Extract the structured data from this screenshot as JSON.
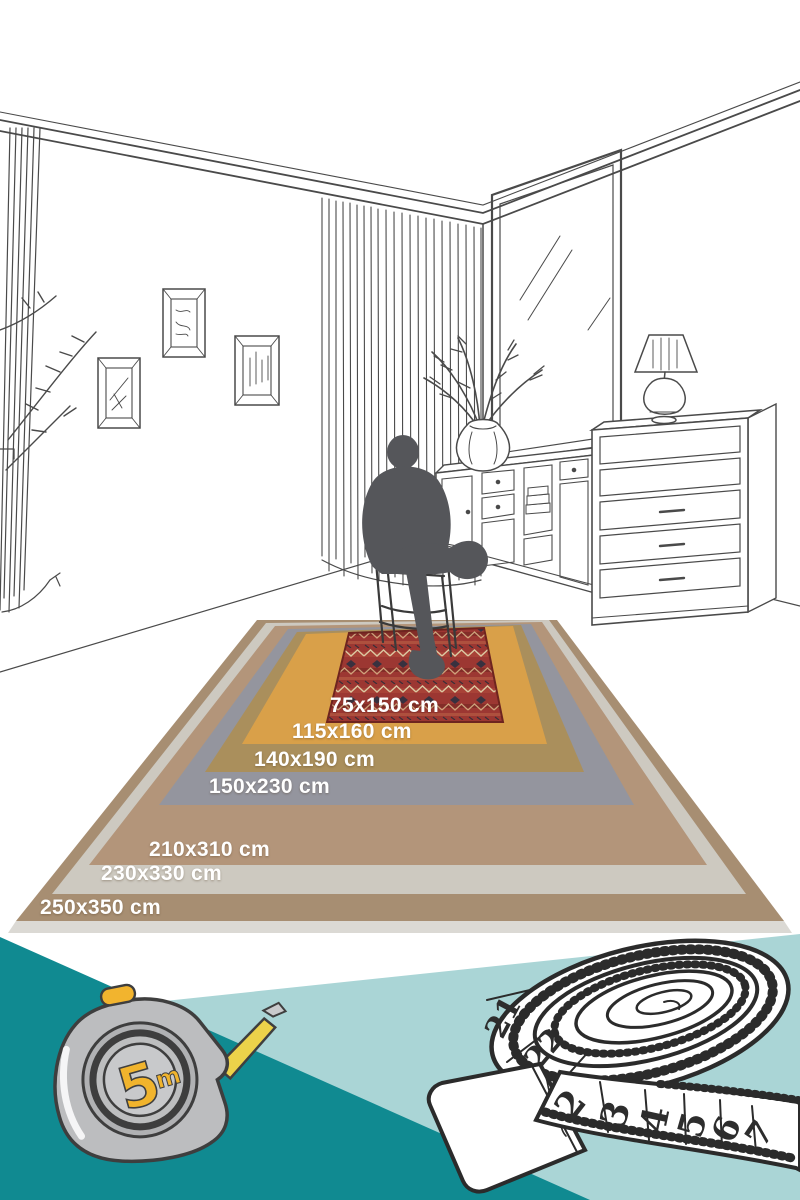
{
  "rugs": {
    "items": [
      {
        "label": "250x350 cm",
        "color": "#a78e72"
      },
      {
        "label": "230x330 cm",
        "color": "#cdc9c0"
      },
      {
        "label": "210x310 cm",
        "color": "#b3957a"
      },
      {
        "label": "150x230 cm",
        "color": "#94959e"
      },
      {
        "label": "140x190 cm",
        "color": "#aa8f5c"
      },
      {
        "label": "115x160 cm",
        "color": "#d9a049"
      },
      {
        "label": "75x150 cm",
        "color": "#9c3732"
      }
    ],
    "pattern_colors": {
      "zigzag_light": "#dcc9a2",
      "diamond_dark": "#38313f",
      "mottle_orange": "#c06a4a"
    }
  },
  "scene": {
    "silhouette_color": "#55565a",
    "line_color": "#4a4a4a",
    "elements": [
      "room-corner",
      "crown-molding",
      "curtains",
      "picture-frames",
      "window",
      "plant-vase",
      "sideboard",
      "dresser",
      "table-lamp",
      "books",
      "chair",
      "sitting-person-silhouette"
    ]
  },
  "bottom": {
    "colors": {
      "teal": "#108a91",
      "light_teal": "#aad5d6"
    },
    "tape_measure": {
      "value": "5",
      "unit": "m",
      "body_color": "#bcbdbf",
      "accent_color": "#f1b42d"
    },
    "measuring_tape": {
      "numbers": [
        "21",
        "22",
        "2",
        "3",
        "4",
        "5",
        "6",
        "7"
      ]
    }
  }
}
